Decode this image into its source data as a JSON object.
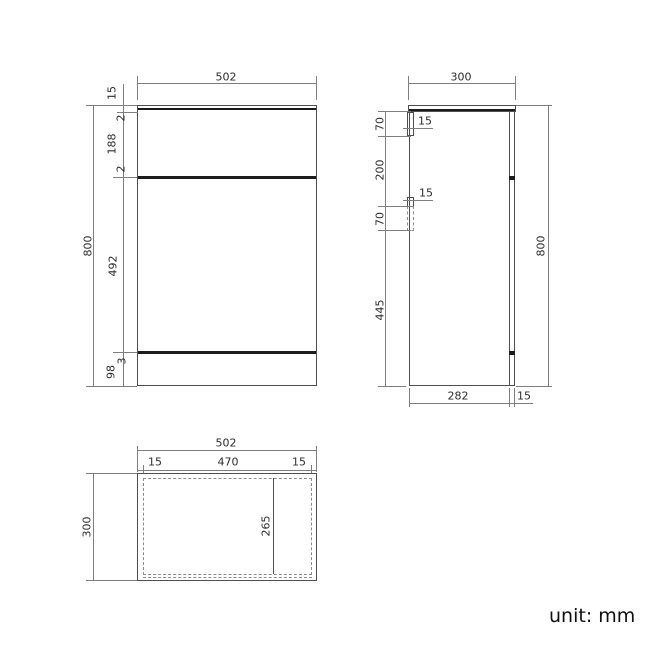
{
  "unit_label": "unit: mm",
  "front": {
    "width": "502",
    "overall_height": "800",
    "counter_thickness": "15",
    "gap_top": "2",
    "drawer_height": "188",
    "gap_mid": "2",
    "door_height": "492",
    "gap_bottom": "3",
    "plinth_height": "98"
  },
  "side": {
    "depth": "300",
    "overall_height": "800",
    "handle1_height": "70",
    "handle_spacing": "200",
    "handle2_height": "70",
    "lower_section_height": "445",
    "handle1_depth": "15",
    "handle2_depth": "15",
    "body_depth": "282",
    "back_panel_depth": "15"
  },
  "plan": {
    "width": "502",
    "depth": "300",
    "left_inset": "15",
    "inner_width": "470",
    "right_inset": "15",
    "partition_depth": "265"
  }
}
